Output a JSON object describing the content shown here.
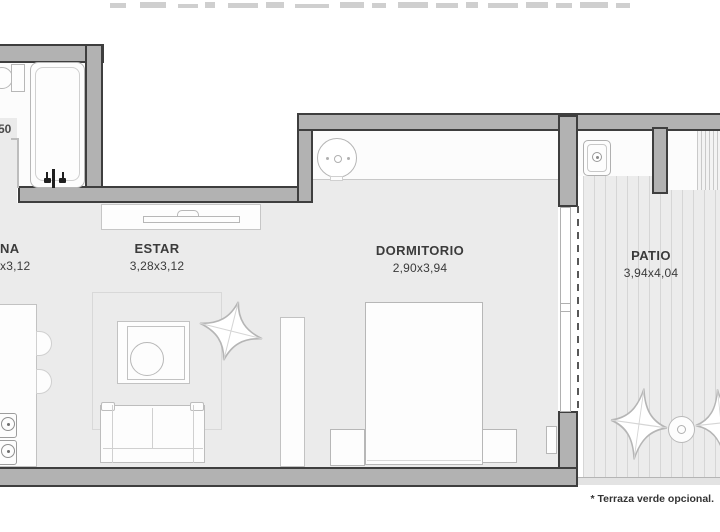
{
  "rooms": [
    {
      "id": "cocina",
      "name": "NA",
      "dims": "x3,12"
    },
    {
      "id": "estar",
      "name": "ESTAR",
      "dims": "3,28x3,12"
    },
    {
      "id": "dormitorio",
      "name": "DORMITORIO",
      "dims": "2,90x3,94"
    },
    {
      "id": "patio",
      "name": "PATIO",
      "dims": "3,94x4,04"
    }
  ],
  "left_dimension_fragment": "50",
  "footnote": "* Terraza verde opcional.",
  "colors": {
    "wall_fill": "#b2b2b2",
    "wall_outline": "#3e3e3e",
    "floor": "#ebebeb",
    "deck_stripe": "#d6d6d6",
    "text": "#3b3b3b"
  }
}
